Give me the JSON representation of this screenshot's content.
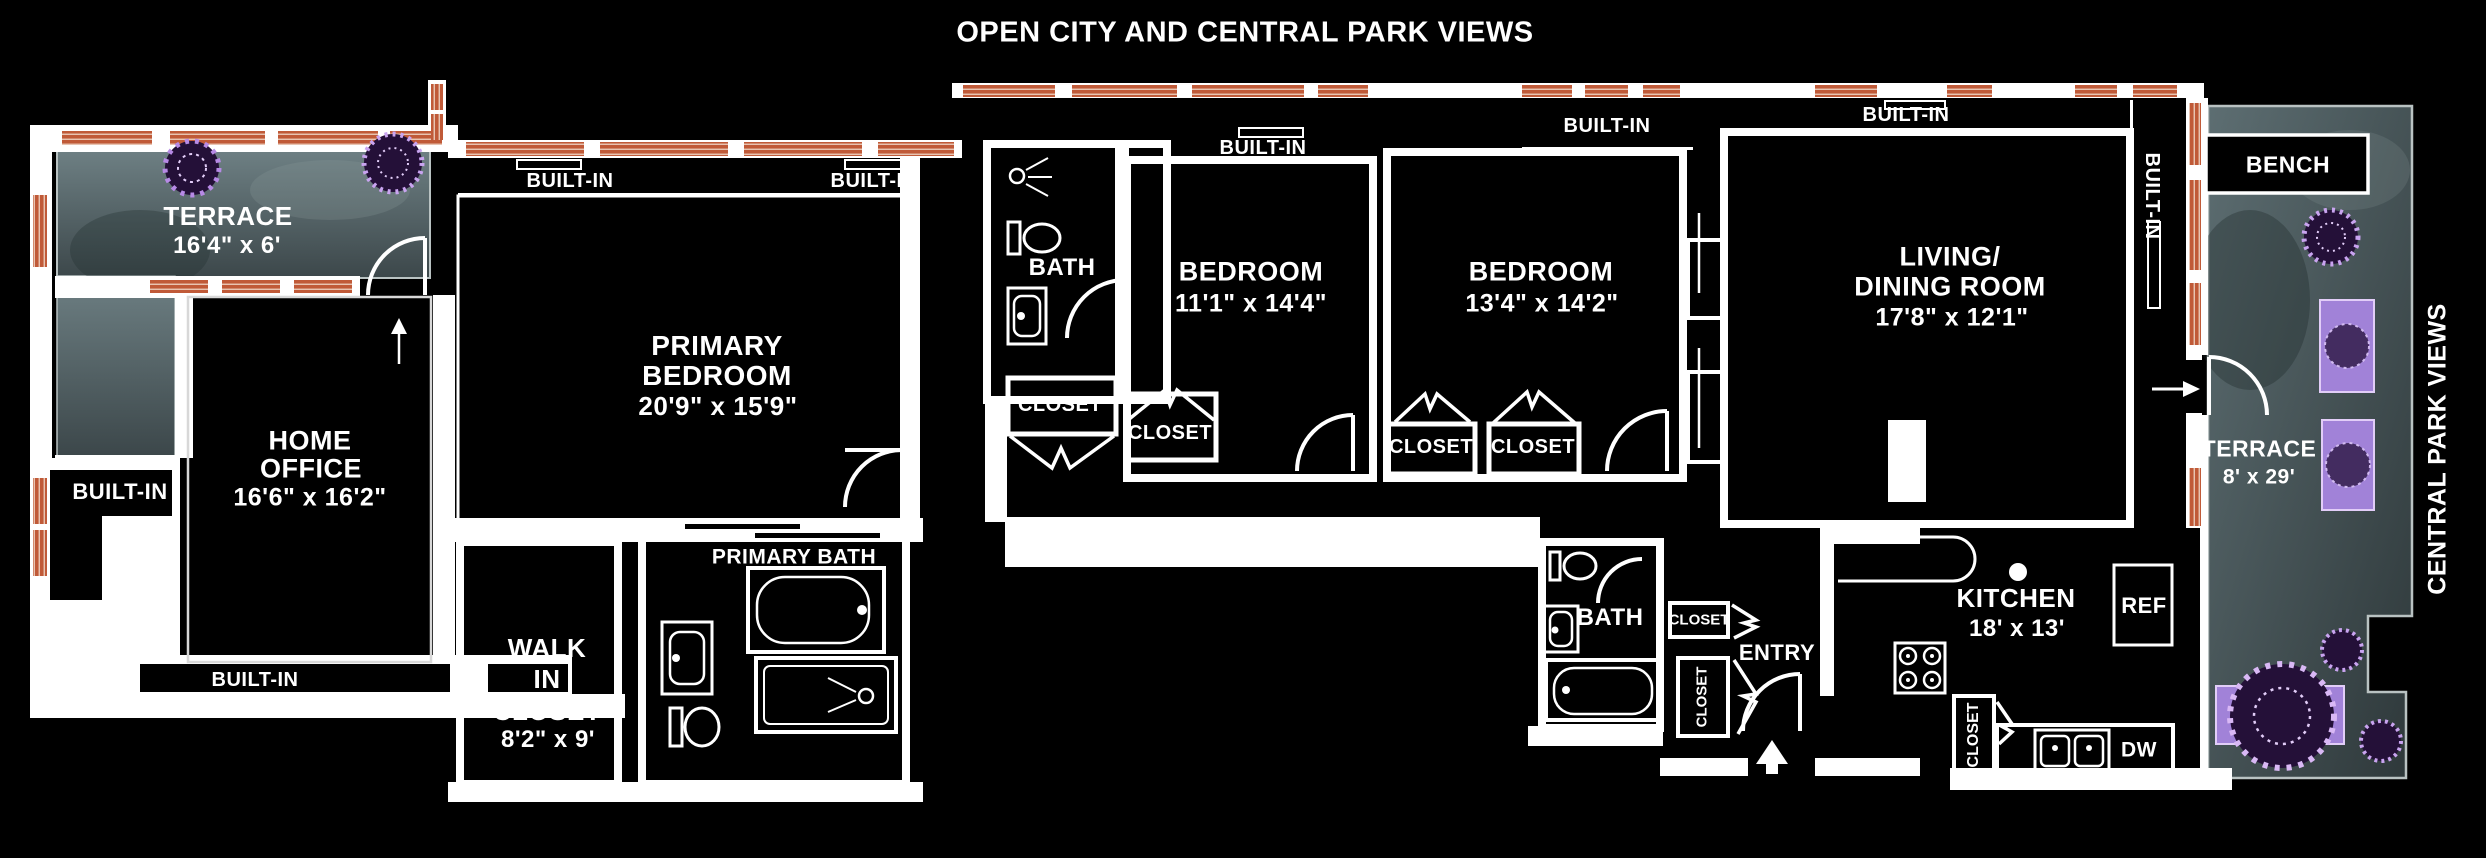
{
  "title": "OPEN CITY AND CENTRAL PARK VIEWS",
  "labels": {
    "built_in": "BUILT-IN",
    "closet": "CLOSET",
    "ref": "REF",
    "dw": "DW",
    "bench": "BENCH",
    "entry": "ENTRY",
    "central_park_views": "CENTRAL PARK VIEWS"
  },
  "rooms": {
    "terrace_top_left": {
      "name": "TERRACE",
      "dims": "16'4\" x 6'"
    },
    "home_office": {
      "line1": "HOME",
      "line2": "OFFICE",
      "dims": "16'6\" x 16'2\""
    },
    "primary_bedroom": {
      "line1": "PRIMARY",
      "line2": "BEDROOM",
      "dims": "20'9\" x 15'9\""
    },
    "walk_in_closet": {
      "line1": "WALK",
      "line2": "IN",
      "line3": "CLOSET",
      "dims": "8'2\" x 9'"
    },
    "primary_bath": {
      "name": "PRIMARY BATH"
    },
    "hall_bath": {
      "name": "BATH"
    },
    "bedroom_1": {
      "name": "BEDROOM",
      "dims": "11'1\" x 14'4\""
    },
    "bedroom_2": {
      "name": "BEDROOM",
      "dims": "13'4\" x 14'2\""
    },
    "living_dining_room": {
      "line1": "LIVING/",
      "line2": "DINING ROOM",
      "dims": "17'8\" x 12'1\""
    },
    "kitchen": {
      "name": "KITCHEN",
      "dims": "18' x 13'"
    },
    "second_bath": {
      "name": "BATH"
    },
    "terrace_right": {
      "name": "TERRACE",
      "dims": "8' x 29'"
    }
  },
  "colors": {
    "wall": "#ffffff",
    "window_hatch": "#c05a38",
    "terrace_floor": "#5d6e72",
    "plant": "#a678d8",
    "background": "#000000"
  }
}
